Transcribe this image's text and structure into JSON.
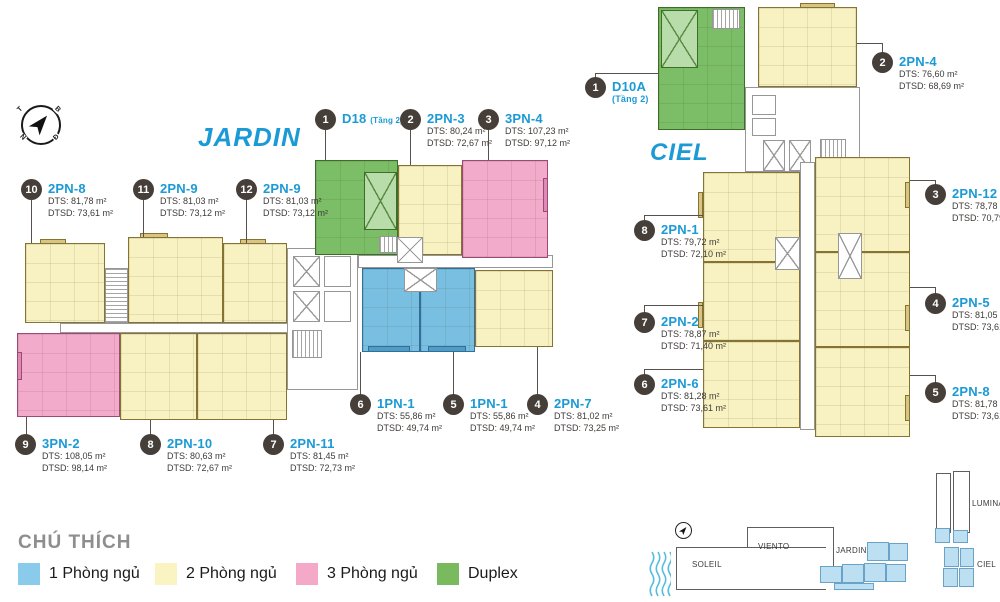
{
  "towers": {
    "jardin": {
      "title": "JARDIN",
      "units": [
        {
          "num": "1",
          "name": "D18",
          "suffix": "(Tầng 2)"
        },
        {
          "num": "2",
          "name": "2PN-3",
          "dts": "DTS: 80,24 m²",
          "dtsd": "DTSD: 72,67 m²"
        },
        {
          "num": "3",
          "name": "3PN-4",
          "dts": "DTS: 107,23 m²",
          "dtsd": "DTSD: 97,12 m²"
        },
        {
          "num": "4",
          "name": "2PN-7",
          "dts": "DTS: 81,02 m²",
          "dtsd": "DTSD: 73,25 m²"
        },
        {
          "num": "5",
          "name": "1PN-1",
          "dts": "DTS: 55,86 m²",
          "dtsd": "DTSD: 49,74 m²"
        },
        {
          "num": "6",
          "name": "1PN-1",
          "dts": "DTS: 55,86 m²",
          "dtsd": "DTSD: 49,74 m²"
        },
        {
          "num": "7",
          "name": "2PN-11",
          "dts": "DTS: 81,45 m²",
          "dtsd": "DTSD: 72,73 m²"
        },
        {
          "num": "8",
          "name": "2PN-10",
          "dts": "DTS: 80,63 m²",
          "dtsd": "DTSD: 72,67 m²"
        },
        {
          "num": "9",
          "name": "3PN-2",
          "dts": "DTS: 108,05 m²",
          "dtsd": "DTSD: 98,14 m²"
        },
        {
          "num": "10",
          "name": "2PN-8",
          "dts": "DTS: 81,78 m²",
          "dtsd": "DTSD: 73,61 m²"
        },
        {
          "num": "11",
          "name": "2PN-9",
          "dts": "DTS: 81,03 m²",
          "dtsd": "DTSD: 73,12 m²"
        },
        {
          "num": "12",
          "name": "2PN-9",
          "dts": "DTS: 81,03 m²",
          "dtsd": "DTSD: 73,12 m²"
        }
      ]
    },
    "ciel": {
      "title": "CIEL",
      "units": [
        {
          "num": "1",
          "name": "D10A",
          "suffix": "(Tầng 2)"
        },
        {
          "num": "2",
          "name": "2PN-4",
          "dts": "DTS: 76,60 m²",
          "dtsd": "DTSD: 68,69 m²"
        },
        {
          "num": "3",
          "name": "2PN-12",
          "dts": "DTS: 78,78 m²",
          "dtsd": "DTSD: 70,79 m²"
        },
        {
          "num": "4",
          "name": "2PN-5",
          "dts": "DTS: 81,05 m²",
          "dtsd": "DTSD: 73,61 m²"
        },
        {
          "num": "5",
          "name": "2PN-8",
          "dts": "DTS: 81,78 m²",
          "dtsd": "DTSD: 73,61 m²"
        },
        {
          "num": "6",
          "name": "2PN-6",
          "dts": "DTS: 81,28 m²",
          "dtsd": "DTSD: 73,61 m²"
        },
        {
          "num": "7",
          "name": "2PN-2",
          "dts": "DTS: 78,87 m²",
          "dtsd": "DTSD: 71,40 m²"
        },
        {
          "num": "8",
          "name": "2PN-1",
          "dts": "DTS: 79,72 m²",
          "dtsd": "DTSD: 72,10 m²"
        }
      ]
    }
  },
  "compass": {
    "letters": {
      "t": "T",
      "b": "B",
      "n": "N",
      "d": "Đ"
    }
  },
  "legend": {
    "title": "CHÚ THÍCH",
    "items": [
      {
        "label": "1 Phòng ngủ",
        "color": "#8acaeb"
      },
      {
        "label": "2 Phòng ngủ",
        "color": "#faf4c3"
      },
      {
        "label": "3 Phòng ngủ",
        "color": "#f5a9c9"
      },
      {
        "label": "Duplex",
        "color": "#79ba5e"
      }
    ]
  },
  "minimap": {
    "labels": {
      "soleil": "SOLEIL",
      "viento": "VIENTO",
      "jardin": "JARDIN",
      "ciel": "CIEL",
      "lumina": "LUMINA"
    }
  },
  "colors": {
    "accent_blue": "#1b9ad6",
    "badge": "#463f39",
    "unit_1pn": "#79bfe2",
    "unit_2pn": "#f8f2c2",
    "unit_3pn": "#f3abcb",
    "unit_duplex": "#7cbd67"
  }
}
